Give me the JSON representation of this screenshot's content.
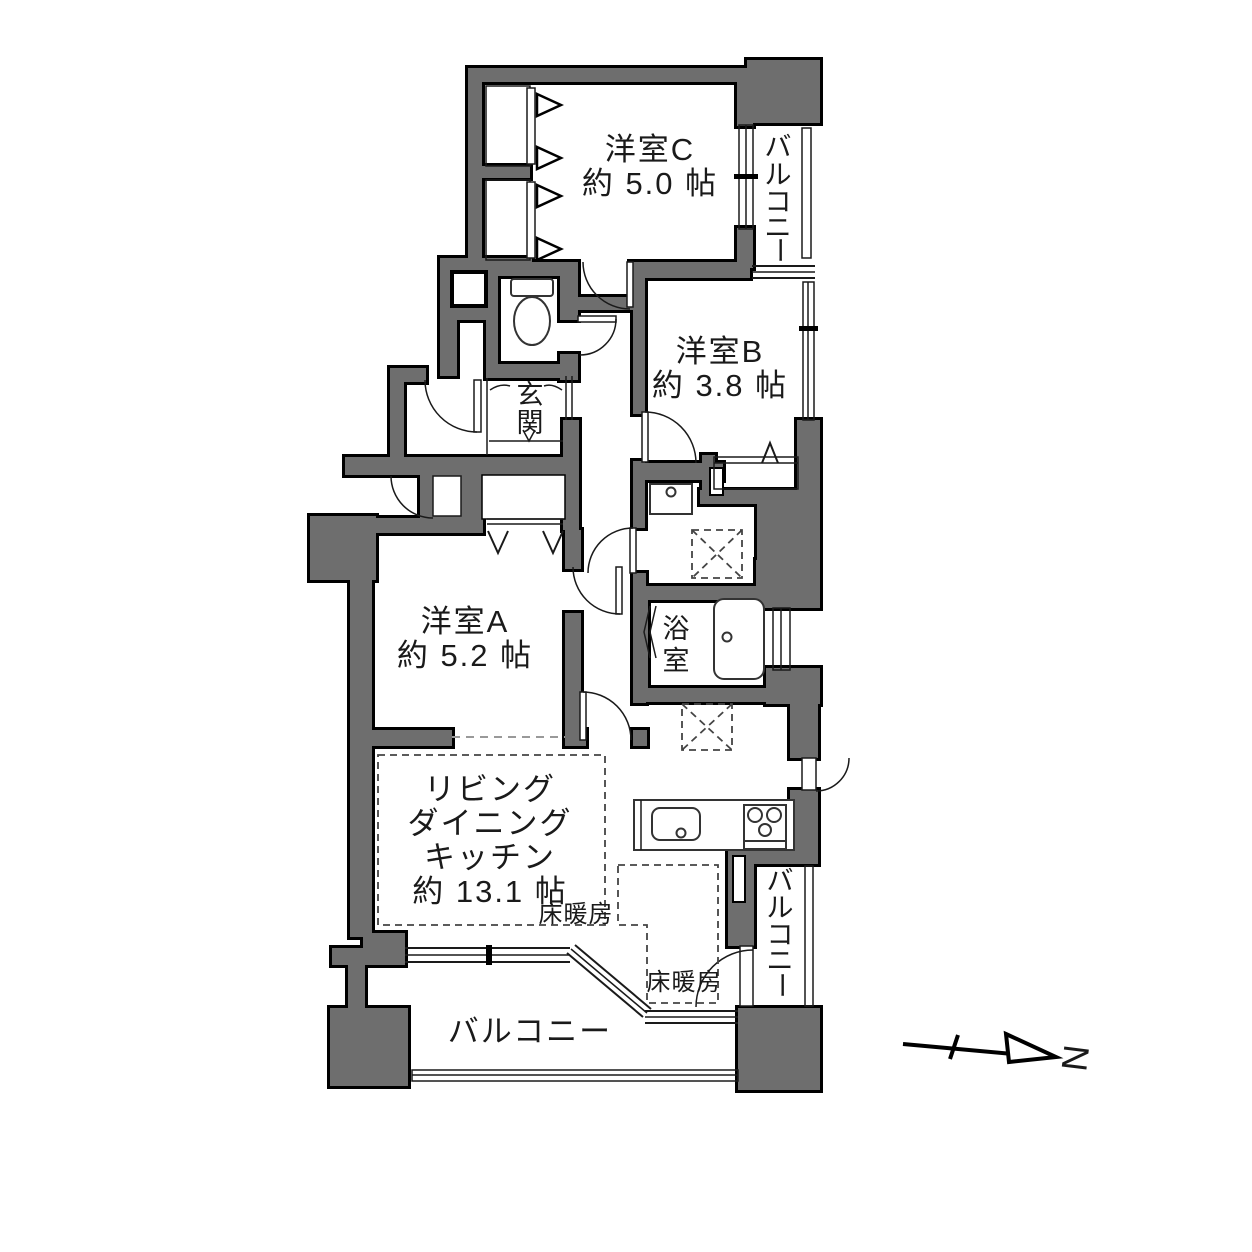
{
  "plan": {
    "room_c": {
      "name": "洋室C",
      "area": "約 5.0 帖"
    },
    "room_b": {
      "name": "洋室B",
      "area": "約 3.8 帖"
    },
    "room_a": {
      "name": "洋室A",
      "area": "約 5.2 帖"
    },
    "ldk": {
      "line1": "リビング",
      "line2": "ダイニング",
      "line3": "キッチン",
      "area": "約 13.1 帖"
    },
    "genkan": {
      "chars": [
        "玄",
        "関"
      ]
    },
    "bath": {
      "chars": [
        "浴",
        "室"
      ]
    },
    "balcony": {
      "label": "バルコニー",
      "chars": [
        "バ",
        "ル",
        "コ",
        "ニ",
        "ー"
      ]
    },
    "floor_heating_living": "床暖房",
    "floor_heating_kitchen": "床暖房",
    "compass": {
      "north": "N"
    },
    "colors": {
      "wall_fill": "#6e6e6e",
      "outline": "#000000",
      "background": "#ffffff"
    }
  }
}
